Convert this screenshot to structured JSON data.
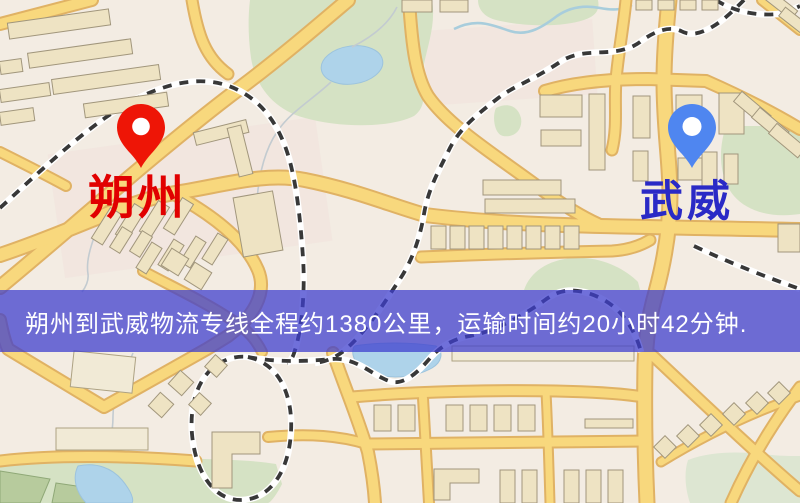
{
  "banner": {
    "text": "朔州到武威物流专线全程约1380公里，运输时间约20小时42分钟.",
    "background": "#3e3ecd",
    "text_color": "#ffffff"
  },
  "origin": {
    "name": "朔州",
    "pin_color": "#ee1506",
    "label_color": "#e10000"
  },
  "destination": {
    "name": "武威",
    "pin_color": "#4f86f0",
    "label_color": "#2a2ac6"
  },
  "route": {
    "distance_km": "1380",
    "duration": "20小时42分钟"
  },
  "map_palette": {
    "background": "#f3ece3",
    "road_fill": "#f8d87d",
    "road_border": "#e0b264",
    "building": "#eee3c3",
    "park_green": "#d5e2c4",
    "water_blue": "#aed3ea",
    "railway_dash": "#383838"
  }
}
